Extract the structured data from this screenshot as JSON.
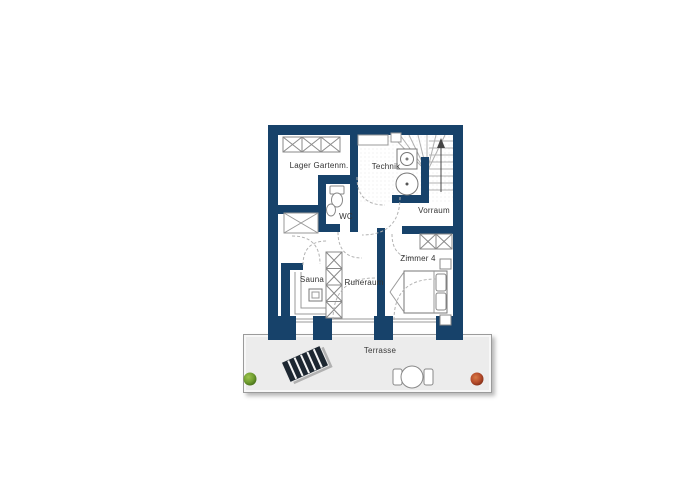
{
  "title": "Floor plan basement with terrace",
  "rooms": {
    "lager": {
      "label": "Lager Gartenm."
    },
    "technik": {
      "label": "Technik"
    },
    "wc": {
      "label": "WC"
    },
    "vorraum": {
      "label": "Vorraum"
    },
    "sauna": {
      "label": "Sauna"
    },
    "ruheraum": {
      "label": "Ruheraum"
    },
    "zimmer4": {
      "label": "Zimmer 4"
    },
    "terrasse": {
      "label": "Terrasse"
    }
  },
  "colors": {
    "wall": "#17426a",
    "terrace_fill": "#ececec",
    "thin_line": "#8a8a8a",
    "door_arc": "#b3b3b3",
    "lounger": "#1d2731",
    "plant_green": "#6f9d2f",
    "plant_red": "#b34a2a"
  },
  "icons": [
    "staircase-icon",
    "stair-direction-arrow-icon",
    "washing-machine-icon",
    "boiler-icon",
    "toilet-icon",
    "sink-icon",
    "wardrobe-icon",
    "bed-icon",
    "sauna-bench-icon",
    "sauna-heater-icon",
    "storage-cabinet-icon",
    "shaft-cross-icon",
    "sun-lounger-icon",
    "terrace-table-icon",
    "terrace-chair-icon",
    "plant-icon"
  ]
}
